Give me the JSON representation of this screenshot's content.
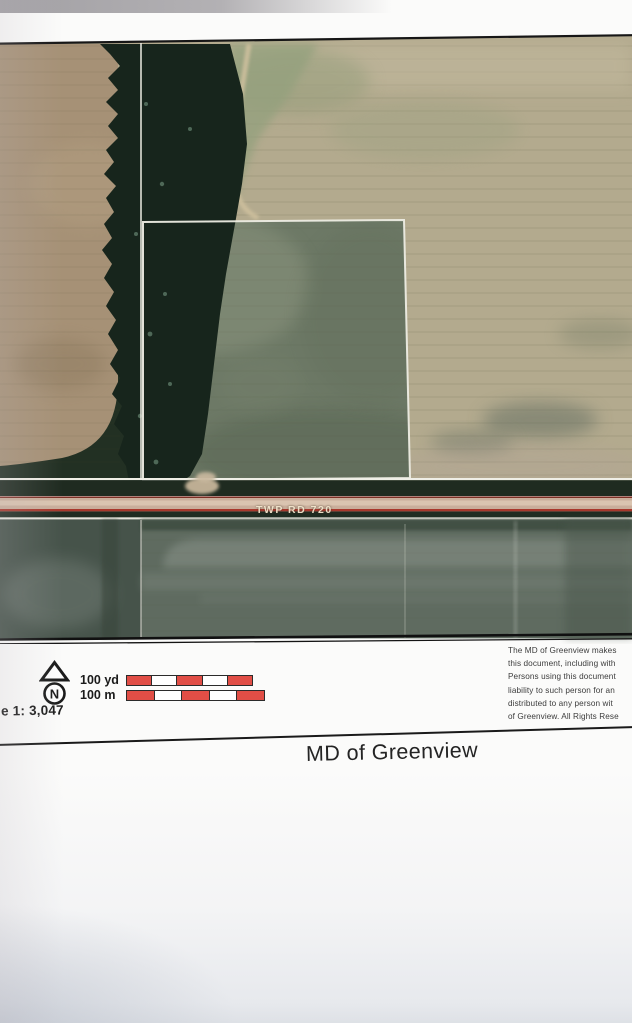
{
  "page": {
    "title": "MD of Greenview"
  },
  "map": {
    "road_label": "TWP RD 720",
    "north_letter": "N",
    "scale_text": "e 1: 3,047",
    "scale_bars": [
      {
        "label": "100 yd"
      },
      {
        "label": "100 m"
      }
    ],
    "disclaimer_lines": [
      "The MD of Greenview makes",
      "this document, including with",
      "Persons using this document",
      "liability to such person for an",
      "distributed to any person wit",
      "of Greenview. All Rights Rese"
    ]
  },
  "colors": {
    "scale_bar_red": "#e14e46",
    "road_edge_red": "#a8382c",
    "road_surface_tan": "#c9ae9b",
    "field_tan": "#b3aa8e",
    "left_field_brown": "#a69176",
    "parcel_green_gray": "#6d7966",
    "trees_dark": "#17251c",
    "boundary_line_white": "#edece3",
    "below_road_green": "#5f6b60"
  }
}
